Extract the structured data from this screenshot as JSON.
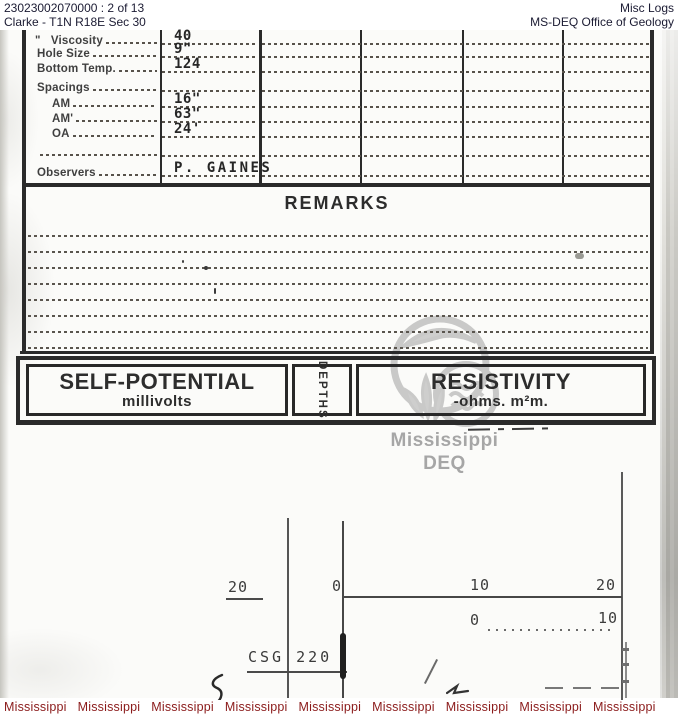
{
  "header": {
    "doc_id": "23023002070000 : 2 of 13",
    "location": "Clarke - T1N R18E Sec 30",
    "category": "Misc Logs",
    "office": "MS-DEQ Office of Geology"
  },
  "form": {
    "fields": [
      {
        "label": "\"   Viscosity",
        "value": "40"
      },
      {
        "label": "Hole Size",
        "value": "9\""
      },
      {
        "label": "Bottom Temp.",
        "value": "124"
      },
      {
        "label": "Spacings",
        "value": ""
      },
      {
        "label": "AM",
        "value": "16\""
      },
      {
        "label": "AM'",
        "value": "63\""
      },
      {
        "label": "OA",
        "value": "24'"
      },
      {
        "label": "",
        "value": ""
      },
      {
        "label": "Observers",
        "value": "P. GAINES"
      }
    ]
  },
  "remarks": {
    "title": "REMARKS"
  },
  "log_header": {
    "sp_title": "SELF-POTENTIAL",
    "sp_subtitle": "millivolts",
    "depth_title": "DEPTHS",
    "res_title": "RESISTIVITY",
    "res_subtitle": "-ohms. m²m."
  },
  "watermark": {
    "line1": "Mississippi",
    "line2": "DEQ"
  },
  "chart": {
    "sp_scale_label": "20",
    "res_scale_1": {
      "left": "0",
      "mid": "10",
      "right": "20"
    },
    "res_scale_2": {
      "left": "0",
      "right": "10"
    },
    "annotation": "CSG 220"
  },
  "footer": {
    "items": [
      "Mississippi",
      "Mississippi",
      "Mississippi",
      "Mississippi",
      "Mississippi",
      "Mississippi",
      "Mississippi",
      "Mississippi",
      "Mississippi"
    ]
  },
  "colors": {
    "footer_text": "#8b1b1b",
    "watermark_gray": "#a6a6a6",
    "ink": "#2a2a2a",
    "header_text": "#1b1b33"
  }
}
